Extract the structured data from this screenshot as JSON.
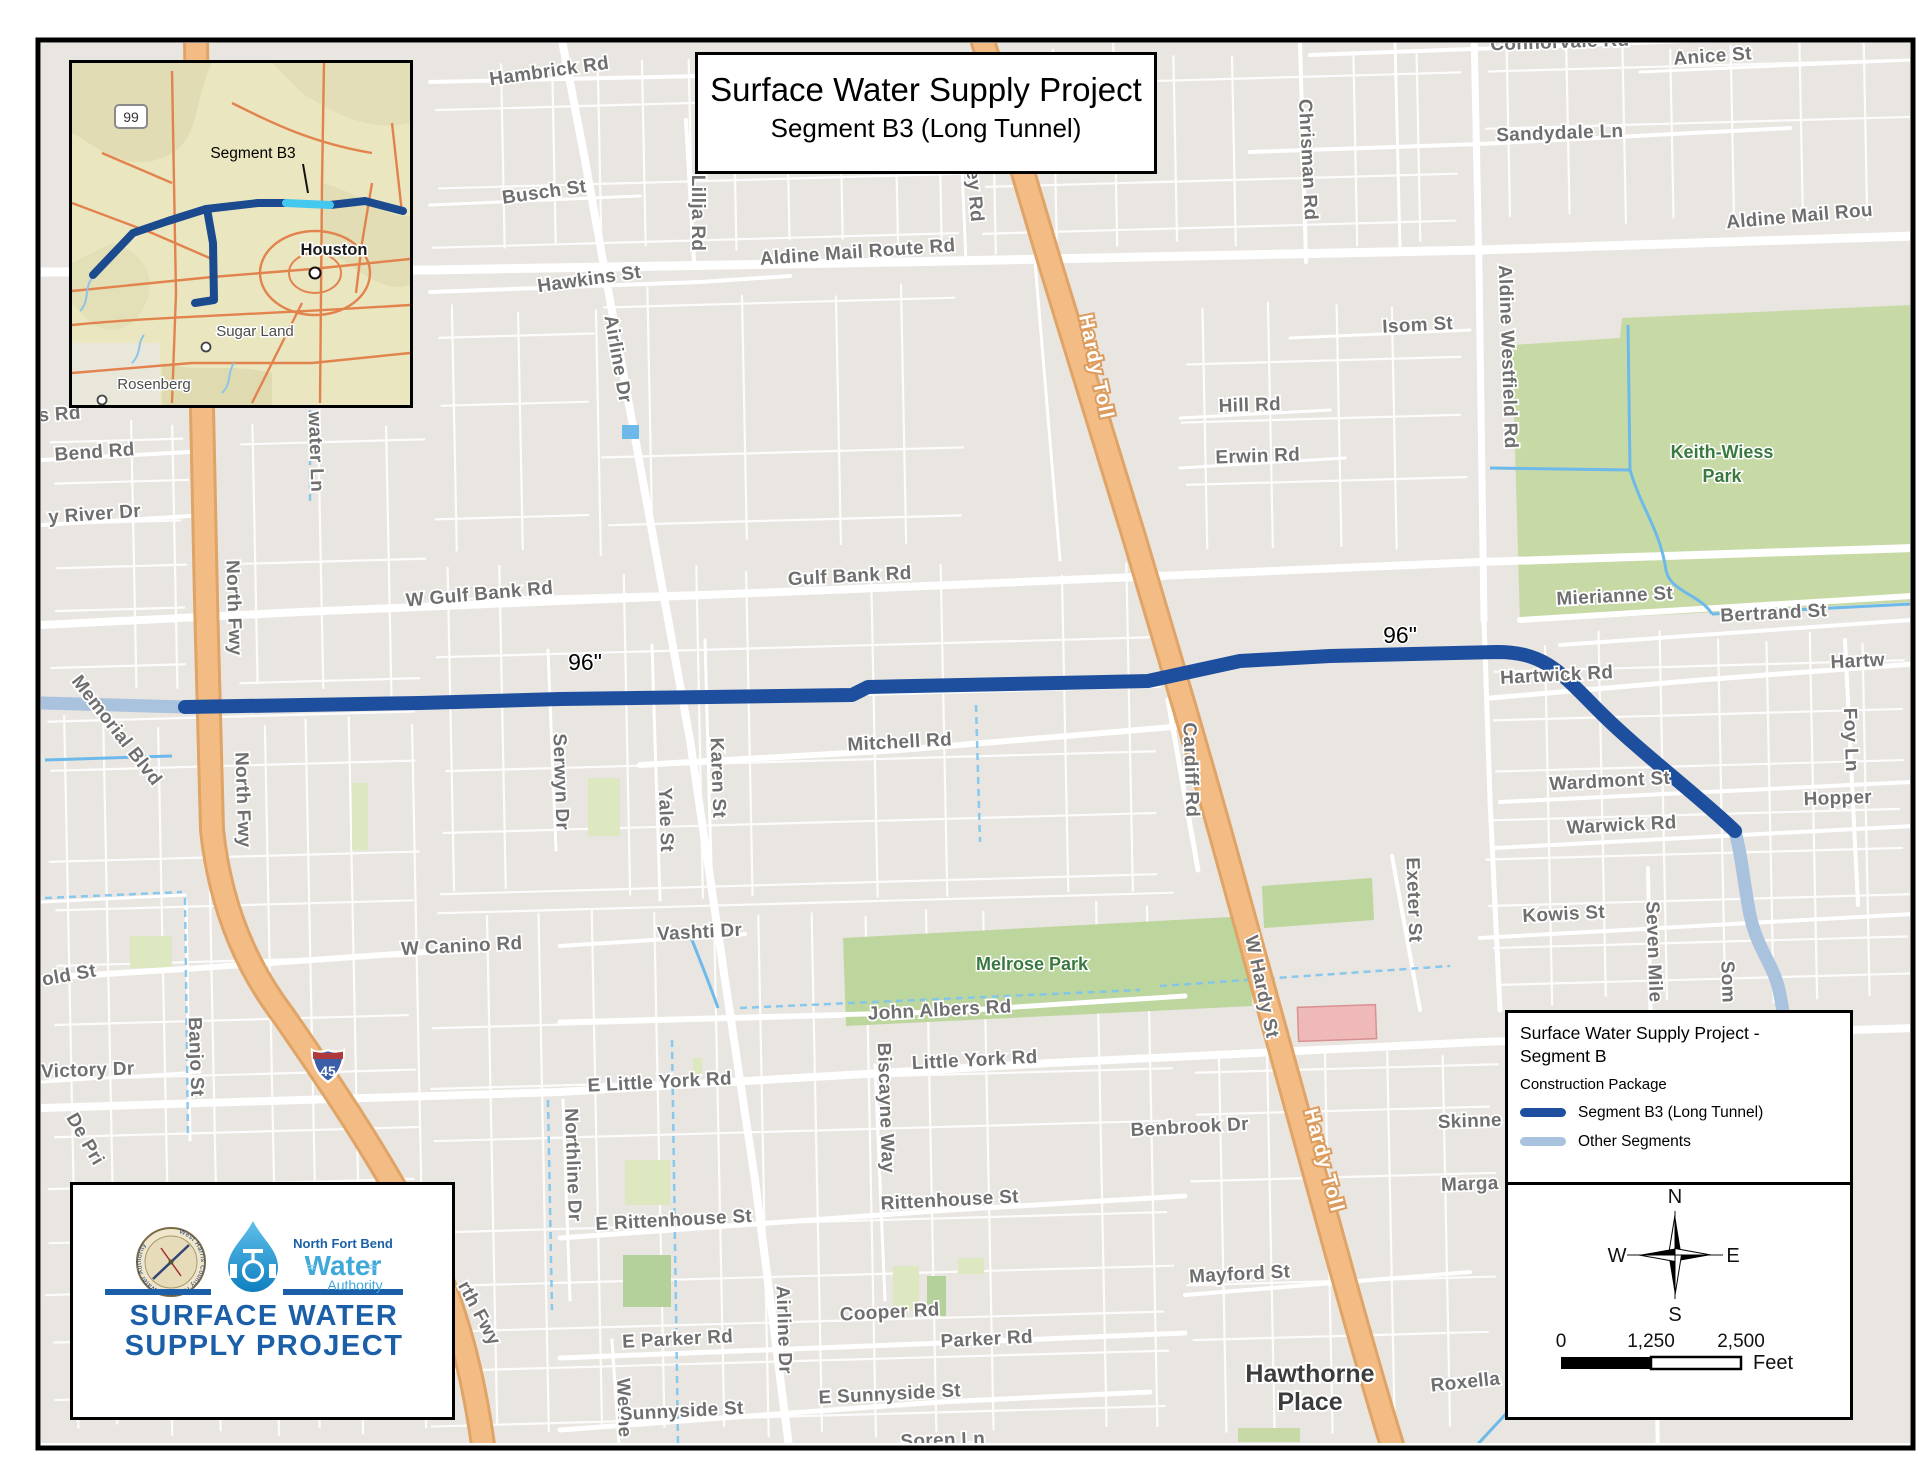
{
  "title_box": {
    "line1": "Surface Water Supply Project",
    "line2": "Segment B3 (Long Tunnel)"
  },
  "inset": {
    "shield": "99",
    "segment_label": "Segment B3",
    "houston": "Houston",
    "sugar_land": "Sugar Land",
    "rosenberg": "Rosenberg"
  },
  "legend": {
    "title_line1": "Surface Water Supply Project -",
    "title_line2": "Segment B",
    "subtitle": "Construction Package",
    "items": [
      {
        "label": "Segment B3 (Long Tunnel)",
        "color": "#1d4f9e"
      },
      {
        "label": "Other Segments",
        "color": "#a9c2de"
      }
    ]
  },
  "compass": {
    "n": "N",
    "e": "E",
    "s": "S",
    "w": "W"
  },
  "scalebar": {
    "ticks": [
      "0",
      "1,250",
      "2,500"
    ],
    "unit": "Feet"
  },
  "logo": {
    "org_small": "North Fort Bend",
    "org_big": "Water",
    "org_sub": "Authority",
    "seal_text": "West Harris County Regional Water Authority",
    "title_line1": "SURFACE WATER",
    "title_line2": "SUPPLY PROJECT"
  },
  "interstate_shield": "45",
  "pipe_colors": {
    "segment_b3": "#1d4f9e",
    "other_segments": "#a9c2de"
  },
  "street_labels": [
    {
      "t": "Hambrick Rd",
      "x": 550,
      "y": 77,
      "r": -8,
      "c": "lst"
    },
    {
      "t": "Busch St",
      "x": 545,
      "y": 198,
      "r": -8,
      "c": "lst"
    },
    {
      "t": "Hawkins St",
      "x": 590,
      "y": 285,
      "r": -8,
      "c": "lst"
    },
    {
      "t": "Lillja Rd",
      "x": 692,
      "y": 213,
      "r": 90,
      "c": "lst"
    },
    {
      "t": "Aldine Mail Route Rd",
      "x": 858,
      "y": 258,
      "r": -4,
      "c": "lst"
    },
    {
      "t": "ey Rd",
      "x": 969,
      "y": 196,
      "r": 85,
      "c": "lst"
    },
    {
      "t": "Chrisman Rd",
      "x": 1302,
      "y": 160,
      "r": 87,
      "c": "lst"
    },
    {
      "t": "Connorvale Rd",
      "x": 1560,
      "y": 48,
      "r": -2,
      "c": "lst"
    },
    {
      "t": "Anice St",
      "x": 1713,
      "y": 62,
      "r": -4,
      "c": "lst"
    },
    {
      "t": "Sandydale Ln",
      "x": 1560,
      "y": 139,
      "r": -2,
      "c": "lst"
    },
    {
      "t": "Aldine Mail Rou",
      "x": 1800,
      "y": 222,
      "r": -5,
      "c": "lst"
    },
    {
      "t": "Isom St",
      "x": 1418,
      "y": 331,
      "r": -3,
      "c": "lst"
    },
    {
      "t": "Aldine Westfield Rd",
      "x": 1502,
      "y": 357,
      "r": 88,
      "c": "lst"
    },
    {
      "t": "Hill Rd",
      "x": 1250,
      "y": 411,
      "r": -2,
      "c": "lst"
    },
    {
      "t": "Erwin Rd",
      "x": 1258,
      "y": 462,
      "r": -2,
      "c": "lst"
    },
    {
      "t": "Keith-Wiess",
      "x": 1722,
      "y": 458,
      "r": 0,
      "c": "lpark"
    },
    {
      "t": "Park",
      "x": 1722,
      "y": 482,
      "r": 0,
      "c": "lpark"
    },
    {
      "t": "Hardy Toll",
      "x": 1090,
      "y": 368,
      "r": 78,
      "c": "ltoll"
    },
    {
      "t": "Hardy Toll",
      "x": 1318,
      "y": 1162,
      "r": 75,
      "c": "ltoll"
    },
    {
      "t": "W Gulf Bank Rd",
      "x": 480,
      "y": 600,
      "r": -5,
      "c": "lst"
    },
    {
      "t": "Gulf Bank Rd",
      "x": 850,
      "y": 582,
      "r": -3,
      "c": "lst"
    },
    {
      "t": "Mierianne St",
      "x": 1615,
      "y": 602,
      "r": -3,
      "c": "lst"
    },
    {
      "t": "Bertrand St",
      "x": 1774,
      "y": 619,
      "r": -3,
      "c": "lst"
    },
    {
      "t": "Hartwick Rd",
      "x": 1557,
      "y": 681,
      "r": -3,
      "c": "lst"
    },
    {
      "t": "Hartw",
      "x": 1858,
      "y": 667,
      "r": -3,
      "c": "lst"
    },
    {
      "t": "Foy Ln",
      "x": 1845,
      "y": 740,
      "r": 88,
      "c": "lst"
    },
    {
      "t": "Hopper",
      "x": 1838,
      "y": 804,
      "r": -2,
      "c": "lst"
    },
    {
      "t": "Wardmont St",
      "x": 1610,
      "y": 787,
      "r": -3,
      "c": "lst"
    },
    {
      "t": "Warwick Rd",
      "x": 1622,
      "y": 831,
      "r": -3,
      "c": "lst"
    },
    {
      "t": "Kowis St",
      "x": 1564,
      "y": 920,
      "r": -3,
      "c": "lst"
    },
    {
      "t": "Seven Mile",
      "x": 1648,
      "y": 952,
      "r": 88,
      "c": "lst"
    },
    {
      "t": "Som",
      "x": 1722,
      "y": 982,
      "r": 88,
      "c": "lst"
    },
    {
      "t": "Exeter St",
      "x": 1408,
      "y": 900,
      "r": 88,
      "c": "lst"
    },
    {
      "t": "96\"",
      "x": 585,
      "y": 670,
      "r": 0,
      "c": "lpipe"
    },
    {
      "t": "96\"",
      "x": 1400,
      "y": 643,
      "r": 0,
      "c": "lpipe"
    },
    {
      "t": "North Fwy",
      "x": 228,
      "y": 608,
      "r": 88,
      "c": "lst"
    },
    {
      "t": "North Fwy",
      "x": 237,
      "y": 800,
      "r": 88,
      "c": "lst"
    },
    {
      "t": "rth Fwy",
      "x": 474,
      "y": 1316,
      "r": 62,
      "c": "lst"
    },
    {
      "t": "water Ln",
      "x": 310,
      "y": 452,
      "r": 88,
      "c": "lst"
    },
    {
      "t": "s Rd",
      "x": 60,
      "y": 420,
      "r": -4,
      "c": "lst"
    },
    {
      "t": "Bend Rd",
      "x": 95,
      "y": 458,
      "r": -4,
      "c": "lst"
    },
    {
      "t": "y River Dr",
      "x": 95,
      "y": 520,
      "r": -4,
      "c": "lst"
    },
    {
      "t": "Memorial Blvd",
      "x": 112,
      "y": 734,
      "r": 52,
      "c": "lst"
    },
    {
      "t": "Serwyn Dr",
      "x": 555,
      "y": 782,
      "r": 88,
      "c": "lst"
    },
    {
      "t": "Yale St",
      "x": 660,
      "y": 820,
      "r": 88,
      "c": "lst"
    },
    {
      "t": "Karen St",
      "x": 712,
      "y": 778,
      "r": 88,
      "c": "lst"
    },
    {
      "t": "Mitchell Rd",
      "x": 900,
      "y": 748,
      "r": -3,
      "c": "lst"
    },
    {
      "t": "Cardiff Rd",
      "x": 1185,
      "y": 770,
      "r": 88,
      "c": "lst"
    },
    {
      "t": "Melrose Park",
      "x": 1032,
      "y": 970,
      "r": 0,
      "c": "lpark"
    },
    {
      "t": "Vashti Dr",
      "x": 700,
      "y": 938,
      "r": -3,
      "c": "lst"
    },
    {
      "t": "W Canino Rd",
      "x": 462,
      "y": 952,
      "r": -3,
      "c": "lst"
    },
    {
      "t": "John Albers Rd",
      "x": 940,
      "y": 1016,
      "r": -3,
      "c": "lst"
    },
    {
      "t": "Little York Rd",
      "x": 975,
      "y": 1066,
      "r": -3,
      "c": "lst"
    },
    {
      "t": "E Little York Rd",
      "x": 660,
      "y": 1088,
      "r": -3,
      "c": "lst"
    },
    {
      "t": "Biscayne Way",
      "x": 880,
      "y": 1108,
      "r": 88,
      "c": "lst"
    },
    {
      "t": "Benbrook Dr",
      "x": 1190,
      "y": 1133,
      "r": -3,
      "c": "lst"
    },
    {
      "t": "Northline Dr",
      "x": 567,
      "y": 1165,
      "r": 88,
      "c": "lst"
    },
    {
      "t": "Rittenhouse St",
      "x": 950,
      "y": 1206,
      "r": -3,
      "c": "lst"
    },
    {
      "t": "E Rittenhouse St",
      "x": 674,
      "y": 1226,
      "r": -3,
      "c": "lst"
    },
    {
      "t": "Mayford St",
      "x": 1240,
      "y": 1280,
      "r": -3,
      "c": "lst"
    },
    {
      "t": "Cooper Rd",
      "x": 890,
      "y": 1318,
      "r": -3,
      "c": "lst"
    },
    {
      "t": "E Parker Rd",
      "x": 678,
      "y": 1345,
      "r": -3,
      "c": "lst"
    },
    {
      "t": "Parker Rd",
      "x": 987,
      "y": 1345,
      "r": -3,
      "c": "lst"
    },
    {
      "t": "W Hardy St",
      "x": 1256,
      "y": 988,
      "r": 78,
      "c": "lst"
    },
    {
      "t": "Skinne",
      "x": 1470,
      "y": 1127,
      "r": -2,
      "c": "lst"
    },
    {
      "t": "Marga",
      "x": 1470,
      "y": 1190,
      "r": -2,
      "c": "lst"
    },
    {
      "t": "Werne",
      "x": 618,
      "y": 1408,
      "r": 88,
      "c": "lst"
    },
    {
      "t": "Sunnyside St",
      "x": 682,
      "y": 1417,
      "r": -3,
      "c": "lst"
    },
    {
      "t": "E Sunnyside St",
      "x": 890,
      "y": 1400,
      "r": -3,
      "c": "lst"
    },
    {
      "t": "Soren Ln",
      "x": 943,
      "y": 1446,
      "r": -2,
      "c": "lst"
    },
    {
      "t": "Roxella",
      "x": 1466,
      "y": 1388,
      "r": -6,
      "c": "lst"
    },
    {
      "t": "Hawthorne",
      "x": 1310,
      "y": 1382,
      "r": 0,
      "c": "lplace"
    },
    {
      "t": "Place",
      "x": 1310,
      "y": 1410,
      "r": 0,
      "c": "lplace"
    },
    {
      "t": "old St",
      "x": 70,
      "y": 981,
      "r": -10,
      "c": "lst"
    },
    {
      "t": "Victory Dr",
      "x": 88,
      "y": 1076,
      "r": -2,
      "c": "lst"
    },
    {
      "t": "De Pri",
      "x": 80,
      "y": 1142,
      "r": 60,
      "c": "lst"
    },
    {
      "t": "Banjo St",
      "x": 190,
      "y": 1057,
      "r": 88,
      "c": "lst"
    },
    {
      "t": "Airline Dr",
      "x": 612,
      "y": 360,
      "r": 80,
      "c": "lst"
    },
    {
      "t": "Airline Dr",
      "x": 778,
      "y": 1330,
      "r": 88,
      "c": "lst"
    }
  ]
}
